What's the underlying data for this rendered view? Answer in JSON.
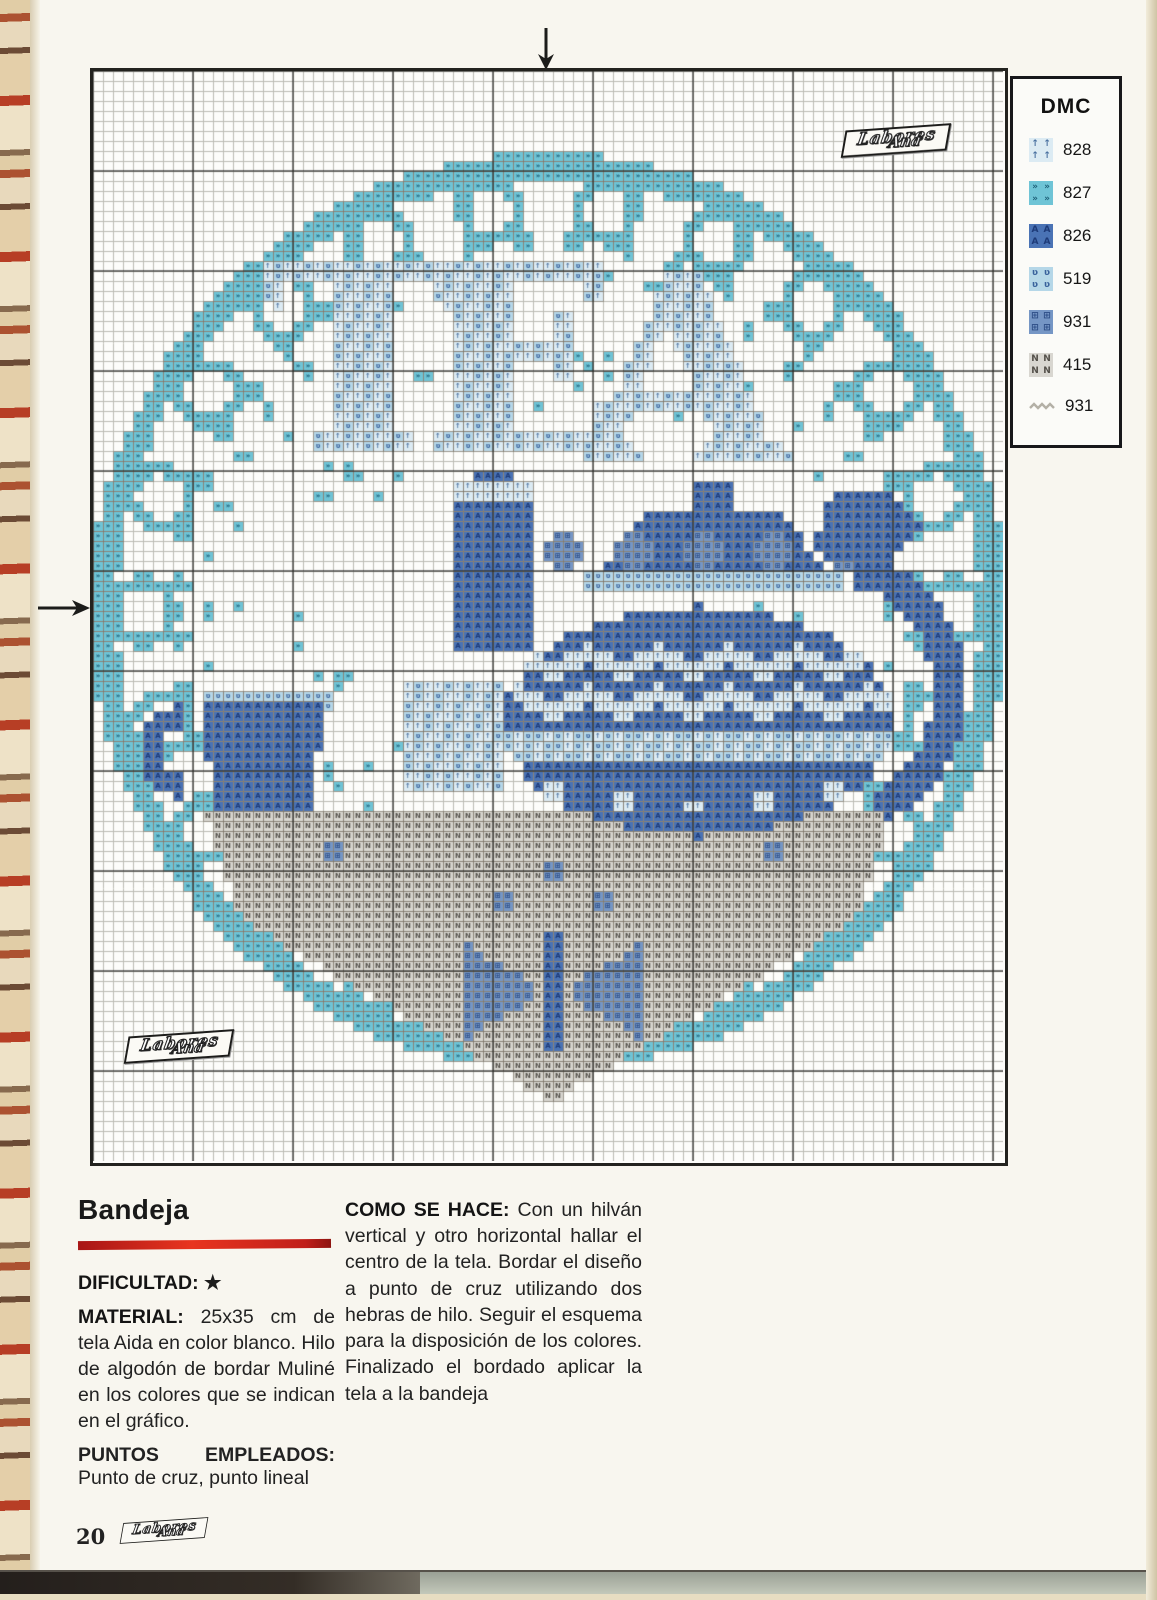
{
  "page": {
    "number": "20"
  },
  "brand": {
    "logo_line1": "Labores",
    "logo_line2": "Ana"
  },
  "legend": {
    "title": "DMC",
    "entries": [
      {
        "code": "828",
        "key": "828"
      },
      {
        "code": "827",
        "key": "827"
      },
      {
        "code": "826",
        "key": "826"
      },
      {
        "code": "519",
        "key": "519"
      },
      {
        "code": "931",
        "key": "931"
      },
      {
        "code": "415",
        "key": "415"
      },
      {
        "code": "931",
        "key": "line"
      }
    ]
  },
  "article": {
    "title": "Bandeja",
    "difficulty_label": "DIFICULTAD:",
    "difficulty_value": "★",
    "material_label": "MATERIAL:",
    "material_text": " 25x35 cm de tela Aida en color blanco. Hilo de algodón de bordar Muliné en los colores que se indican en el gráfico.",
    "stitches_label": "PUNTOS EMPLEADOS:",
    "stitches_text": "Punto de cruz, punto lineal",
    "howto_label": "COMO SE HACE:",
    "howto_text": " Con un hilván vertical y otro horizontal hallar el centro de la tela. Bordar el diseño a punto de cruz utilizando dos hebras de hilo. Seguir el esquema para la disposición de los colores. Finalizado el bordado aplicar la tela a la bandeja"
  },
  "colors": {
    "accent_red": "#c8241c",
    "backstitch_gray": "#b3b0a6",
    "grid_thin": "#bcbcb4",
    "grid_bold": "rgba(42,42,38,0.62)",
    "chart_bg": "#fdfdfa",
    "arrow_black": "#1c1c1a"
  },
  "pattern": {
    "cols": 91,
    "rows": 109,
    "cell": 10,
    "palette": {
      "828": {
        "fill": "#dcebf3",
        "glyph": "↑",
        "gc": "#49709f"
      },
      "827": {
        "fill": "#6fc4d6",
        "glyph": "»",
        "gc": "#1d5e76"
      },
      "826": {
        "fill": "#4a73b5",
        "glyph": "A",
        "gc": "#1d3a78"
      },
      "519": {
        "fill": "#b5d7e8",
        "glyph": "ʋ",
        "gc": "#39629c"
      },
      "931": {
        "fill": "#7596c5",
        "glyph": "⊞",
        "gc": "#2c4c85"
      },
      "415": {
        "fill": "#d8d6d0",
        "glyph": "N",
        "gc": "#54514b"
      }
    },
    "shapes": [
      {
        "t": "annulus",
        "cx": 45.5,
        "cy": 54,
        "r1": 43.2,
        "r2": 45.8,
        "c": "827"
      },
      {
        "t": "ringDots",
        "cx": 45.5,
        "cy": 54,
        "n": 22,
        "R": 40.5,
        "dotR": 3.6,
        "phase": 0,
        "c": "827"
      },
      {
        "t": "ringDots",
        "cx": 45.5,
        "cy": 54,
        "n": 22,
        "R": 40.5,
        "dotR": 2.2,
        "phase": 0,
        "c": "erase"
      },
      {
        "t": "ringDots",
        "cx": 45.5,
        "cy": 54,
        "n": 44,
        "R": 37,
        "dotR": 1.05,
        "phase": 0.5,
        "c": "827"
      },
      {
        "t": "ringDots",
        "cx": 45.5,
        "cy": 54,
        "n": 40,
        "R": 34.3,
        "dotR": 0.8,
        "phase": 0,
        "c": "827"
      },
      {
        "t": "scatter",
        "cx": 45.5,
        "cy": 54,
        "seed": 7,
        "count": 70,
        "R1": 20,
        "R2": 32.5,
        "dotR": 0.6,
        "c": "827"
      },
      {
        "t": "text",
        "chars": [
          [
            "T",
            27,
            31
          ],
          [
            "E",
            43,
            31
          ],
          [
            "A",
            59,
            32
          ]
        ],
        "size": 26,
        "c": "828",
        "mix": "519"
      },
      {
        "t": "poly",
        "pts": [
          [
            11,
            74
          ],
          [
            80,
            74
          ],
          [
            76,
            85
          ],
          [
            15,
            85
          ]
        ],
        "c": "415"
      },
      {
        "t": "poly",
        "pts": [
          [
            15,
            85
          ],
          [
            76,
            85
          ],
          [
            46,
            103
          ]
        ],
        "c": "415"
      },
      {
        "t": "rect",
        "x": 45,
        "y": 86,
        "w": 2,
        "h": 12,
        "c": "826"
      },
      {
        "t": "poly",
        "pts": [
          [
            37,
            87
          ],
          [
            45,
            92
          ],
          [
            37,
            97
          ]
        ],
        "c": "931"
      },
      {
        "t": "poly",
        "pts": [
          [
            55,
            87
          ],
          [
            47,
            92
          ],
          [
            55,
            97
          ]
        ],
        "c": "931"
      },
      {
        "t": "dots",
        "pts": [
          [
            41,
            83
          ],
          [
            51,
            83
          ],
          [
            46,
            80
          ]
        ],
        "r": 1.3,
        "c": "931"
      },
      {
        "t": "dots",
        "pts": [
          [
            24,
            78
          ],
          [
            68,
            78
          ]
        ],
        "r": 1.5,
        "c": "931"
      },
      {
        "t": "rect",
        "x": 31,
        "y": 61,
        "w": 10,
        "h": 11,
        "c": "828",
        "mix": "519"
      },
      {
        "t": "poly",
        "pts": [
          [
            36,
            58
          ],
          [
            36,
            44
          ],
          [
            38,
            40
          ],
          [
            42,
            40
          ],
          [
            44,
            44
          ],
          [
            44,
            58
          ]
        ],
        "c": "826"
      },
      {
        "t": "rect",
        "x": 36,
        "y": 41,
        "w": 8,
        "h": 2,
        "c": "828"
      },
      {
        "t": "ellipse",
        "cx": 62,
        "cy": 42.5,
        "rx": 2,
        "ry": 1.7,
        "c": "826"
      },
      {
        "t": "poly",
        "pts": [
          [
            51,
            50
          ],
          [
            55,
            44
          ],
          [
            69,
            44
          ],
          [
            73,
            50
          ]
        ],
        "c": "826"
      },
      {
        "t": "rect",
        "x": 49,
        "y": 50,
        "w": 26,
        "h": 2,
        "c": "519"
      },
      {
        "t": "dots",
        "pts": [
          [
            47,
            48
          ],
          [
            54,
            48
          ],
          [
            61,
            48
          ],
          [
            68,
            48
          ],
          [
            75,
            48
          ]
        ],
        "r": 1.9,
        "c": "931"
      },
      {
        "t": "poly",
        "pts": [
          [
            72,
            47
          ],
          [
            74,
            42
          ],
          [
            80,
            42
          ],
          [
            83,
            46
          ],
          [
            80,
            49
          ],
          [
            74,
            49
          ]
        ],
        "c": "826"
      },
      {
        "t": "ringSeg",
        "cx": 73,
        "cy": 62,
        "r1": 11,
        "r2": 14.5,
        "a1": -75,
        "a2": 65,
        "c": "826"
      },
      {
        "t": "ellipse",
        "cx": 60.5,
        "cy": 65,
        "rx": 19.5,
        "ry": 11.5,
        "c": "826"
      },
      {
        "t": "zigzagRow",
        "y": 57,
        "x1": 42,
        "x2": 79,
        "amp": 2,
        "period": 7,
        "th": 2,
        "c": "828",
        "clip": {
          "cx": 60.5,
          "cy": 65,
          "rx": 19.5,
          "ry": 11.5
        }
      },
      {
        "t": "zigzagRow",
        "y": 61,
        "x1": 42,
        "x2": 79,
        "amp": 2,
        "period": 7,
        "th": 2,
        "c": "828",
        "clip": {
          "cx": 60.5,
          "cy": 65,
          "rx": 19.5,
          "ry": 11.5
        }
      },
      {
        "t": "rect",
        "x": 41,
        "y": 66,
        "w": 39,
        "h": 3,
        "c": "519",
        "mix": "828",
        "clip": {
          "cx": 60.5,
          "cy": 65,
          "rx": 19.5,
          "ry": 11.5
        }
      },
      {
        "t": "dots",
        "pts": [
          [
            46,
            72
          ],
          [
            53,
            73
          ],
          [
            60,
            73.5
          ],
          [
            67,
            73
          ],
          [
            74,
            72
          ]
        ],
        "r": 1,
        "c": "828"
      },
      {
        "t": "rect",
        "x": 11,
        "y": 62,
        "w": 13,
        "h": 1.5,
        "c": "519"
      },
      {
        "t": "poly",
        "pts": [
          [
            11,
            63
          ],
          [
            23,
            63
          ],
          [
            22,
            74
          ],
          [
            12,
            74
          ]
        ],
        "c": "826"
      },
      {
        "t": "ringSeg",
        "cx": 9.5,
        "cy": 68,
        "r1": 2.6,
        "r2": 4.8,
        "a1": 95,
        "a2": 265,
        "c": "826"
      }
    ]
  }
}
